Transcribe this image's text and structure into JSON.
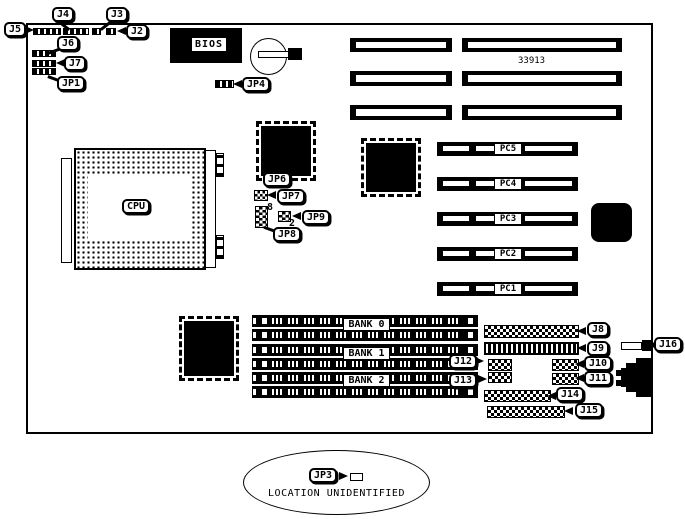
{
  "title": "Motherboard jumper and connector location diagram",
  "board": {
    "part_number": "33913",
    "chips": {
      "cpu": "CPU",
      "bios": "BIOS"
    },
    "labels": {
      "j2": "J2",
      "j3": "J3",
      "j4": "J4",
      "j5": "J5",
      "j6": "J6",
      "j7": "J7",
      "j8": "J8",
      "j9": "J9",
      "j10": "J10",
      "j11": "J11",
      "j12": "J12",
      "j13": "J13",
      "j14": "J14",
      "j15": "J15",
      "j16": "J16",
      "jp1": "JP1",
      "jp3": "JP3",
      "jp4": "JP4",
      "jp6": "JP6",
      "jp7": "JP7",
      "jp8": "JP8",
      "jp9": "JP9"
    },
    "pin_numbers": {
      "jp8_top": "8",
      "jp9_bottom": "2"
    },
    "pci_slots": [
      "PC5",
      "PC4",
      "PC3",
      "PC2",
      "PC1"
    ],
    "memory_banks": [
      "BANK 0",
      "BANK 1",
      "BANK 2"
    ],
    "note": "LOCATION UNIDENTIFIED",
    "colors": {
      "ink": "#000000",
      "paper": "#ffffff"
    }
  }
}
